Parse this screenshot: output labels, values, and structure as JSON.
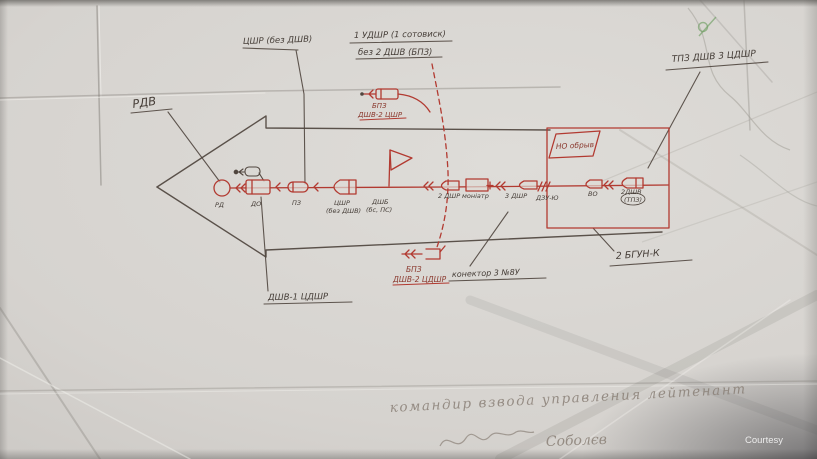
{
  "page": {
    "watermark": "Courtesy"
  },
  "diagram": {
    "callouts": {
      "tsshr": "ЦШР (без ДШВ)",
      "udshr_top": "1 УДШР (1 сотовиск)",
      "udshr_bottom": "без 2 ДШВ (БПЗ)",
      "tpz": "ТПЗ ДШВ 3 ЦДШР",
      "rdv": "РДВ",
      "no_obryv": "НО обрыв",
      "bpz_top": {
        "l1": "БПЗ",
        "l2": "ДШВ-2 ЦШР"
      },
      "bpz_bottom": {
        "l1": "БПЗ",
        "l2": "ДШВ-2 ЦДШР"
      },
      "connector": "конектор 3 №8У",
      "bgun": "2 БГУН-К",
      "dshv1": "ДШВ-1 ЦДШР"
    },
    "chain": [
      {
        "label": "РД"
      },
      {
        "label": "ДО"
      },
      {
        "label": "ПЗ"
      },
      {
        "label": "ЦШР",
        "label2": "(без ДШВ)"
      },
      {
        "label": "ДШБ",
        "label2": "(бс, ПС)"
      },
      {
        "label": "2 ДШР"
      },
      {
        "label": "моніатр"
      },
      {
        "label": "3 ДШР"
      },
      {
        "label": "ДЗУ-Ю"
      },
      {
        "label": "ВО"
      },
      {
        "label": "2ДШВ",
        "label2": "(ТПЗ)"
      }
    ],
    "signature": {
      "line1": "командир взвода управления лейтенант",
      "line2": "Соболєв"
    }
  }
}
